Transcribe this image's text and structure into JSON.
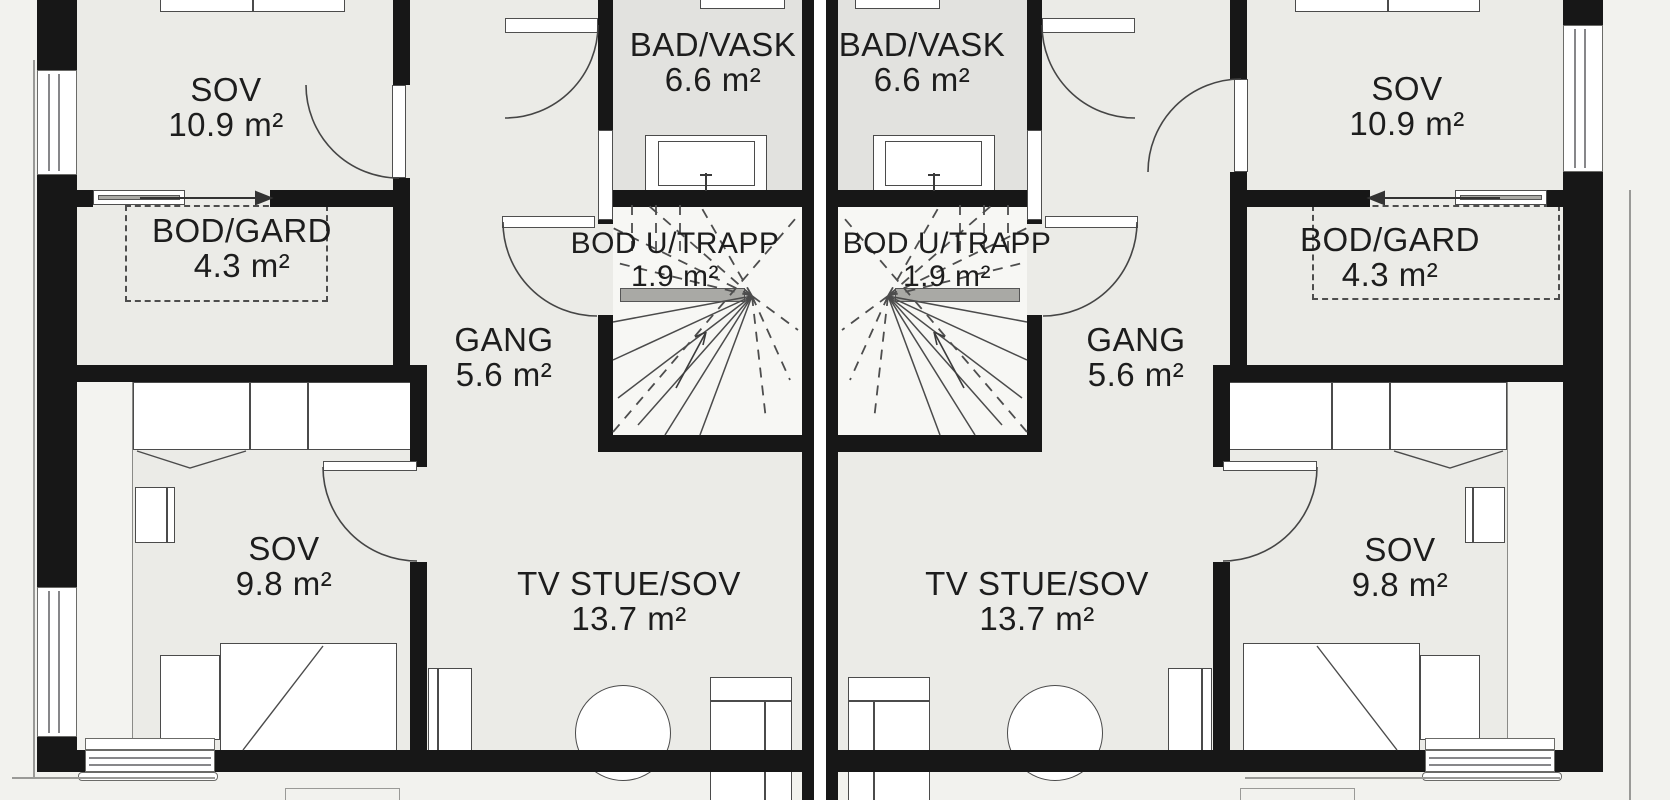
{
  "plan_title": "Duplex upper floor plan",
  "units": [
    {
      "id": "left",
      "rooms": [
        {
          "key": "sov-top",
          "name": "SOV",
          "area": "10.9 m²"
        },
        {
          "key": "bod-gard",
          "name": "BOD/GARD",
          "area": "4.3 m²"
        },
        {
          "key": "bad-vask",
          "name": "BAD/VASK",
          "area": "6.6 m²"
        },
        {
          "key": "bod-u-trapp",
          "name": "BOD U/TRAPP",
          "area": "1.9 m²"
        },
        {
          "key": "gang",
          "name": "GANG",
          "area": "5.6 m²"
        },
        {
          "key": "tv-stue",
          "name": "TV STUE/SOV",
          "area": "13.7 m²"
        },
        {
          "key": "sov-bottom",
          "name": "SOV",
          "area": "9.8 m²"
        }
      ]
    },
    {
      "id": "right",
      "rooms": [
        {
          "key": "sov-top",
          "name": "SOV",
          "area": "10.9 m²"
        },
        {
          "key": "bod-gard",
          "name": "BOD/GARD",
          "area": "4.3 m²"
        },
        {
          "key": "bad-vask",
          "name": "BAD/VASK",
          "area": "6.6 m²"
        },
        {
          "key": "bod-u-trapp",
          "name": "BOD U/TRAPP",
          "area": "1.9 m²"
        },
        {
          "key": "gang",
          "name": "GANG",
          "area": "5.6 m²"
        },
        {
          "key": "tv-stue",
          "name": "TV STUE/SOV",
          "area": "13.7 m²"
        },
        {
          "key": "sov-bottom",
          "name": "SOV",
          "area": "9.8 m²"
        }
      ]
    }
  ],
  "colors": {
    "wall": "#171717",
    "room": "#ebebe7",
    "bath": "#e2e2df",
    "stair": "#f7f7f4",
    "outside": "#f2f2ee",
    "furn": "#4b4b4b",
    "text": "#1d1d1d",
    "thin": "#9a9a97"
  }
}
